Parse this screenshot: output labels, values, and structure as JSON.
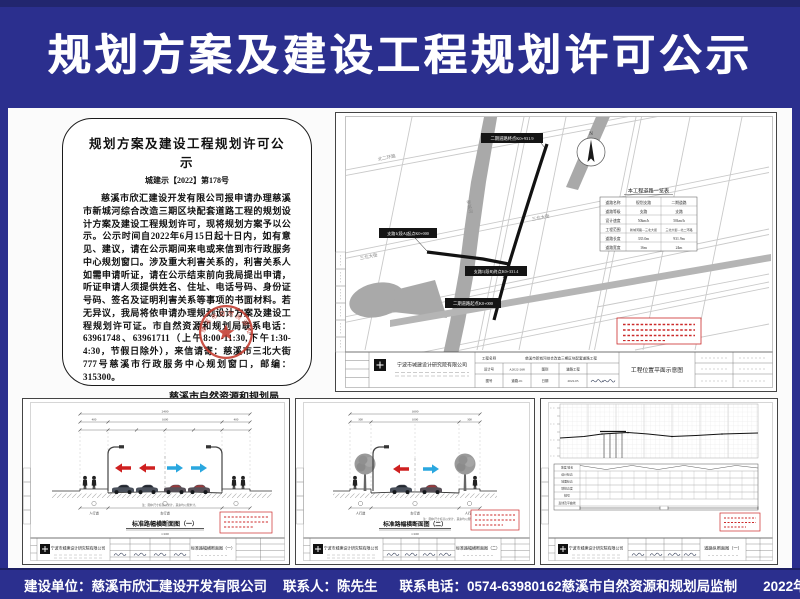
{
  "banner": {
    "title": "规划方案及建设工程规划许可公示"
  },
  "notice": {
    "title": "规划方案及建设工程规划许可公示",
    "doc_no": "城建示【2022】第178号",
    "body": "慈溪市欣汇建设开发有限公司报申请办理慈溪市新城河综合改造三期区块配套道路工程的规划设计方案及建设工程规划许可，现将规划方案予以公示。公示时间自2022年6月15日起十日内，如有意见、建议，请在公示期间来电或来信到市行政服务中心规划窗口。涉及重大利害关系的，利害关系人如需申请听证，请在公示结束前向我局提出申请，听证申请人须提供姓名、住址、电话号码、身份证号码、签名及证明利害关系等事项的书面材料。若无异议，我局将依申请办理规划设计方案及建设工程规划许可证。市自然资源和规划局联系电话：63961748、63961711（上午8:00-11:30,下午1:30-4:30，节假日除外），来信请寄：慈溪市三北大街777号慈溪市行政服务中心规划窗口，邮编：315300。",
    "signature": "慈溪市自然资源和规划局",
    "date": "二〇二二年六月十四日"
  },
  "company": "宁波市城建设计研究院有限公司",
  "site_plan": {
    "project_label": "工程名称",
    "project_name": "慈溪市新城河综合改造三期区块配套道路工程",
    "drawing_title": "工程位置平面示意图",
    "design_no_label": "设计号",
    "design_no": "A2022-268",
    "category_label": "图别",
    "category": "道路工程",
    "sheet_label": "图号",
    "sheet": "道路-01",
    "date_label": "日期",
    "date_value": "2022.05",
    "north_label": "N",
    "road_table": {
      "title": "本工程道路一览表",
      "rows": [
        [
          "道路名称",
          "规划支路",
          "二期道路"
        ],
        [
          "道路等级",
          "支路",
          "支路"
        ],
        [
          "设计速度",
          "50km/h",
          "50km/h"
        ],
        [
          "工程范围",
          "新城河路—三北大街",
          "三北大街—北二环路"
        ],
        [
          "道路长度",
          "335.0m",
          "931.9m"
        ],
        [
          "道路宽度",
          "16m",
          "24m"
        ]
      ]
    },
    "route_labels": {
      "end2": "二期道路终点K0+931.9",
      "branch_start": "支路1(段A)起点K0+000",
      "branch_end": "支路1(段B)终点K0+331.4",
      "start2": "二期道路起点K0+000"
    },
    "streets": {
      "north_ring": "北二环路",
      "sanbei": "三北大街",
      "sanbei2": "三北大街",
      "river": "新城河"
    }
  },
  "section_a": {
    "title": "标准路幅横断面图（一）",
    "scale": "1:100",
    "dim_total": "2400",
    "dim_left": "400",
    "dim_mid": "1600",
    "dim_right": "400",
    "zone_left": "人行道",
    "zone_mid": "车行道",
    "zone_right": "人行道",
    "note": "注：图中尺寸标高以米计，其余均以厘米计。"
  },
  "section_b": {
    "title": "标准路幅横断面图（二）",
    "scale": "1:100",
    "dim_total": "1600",
    "dim_left": "300",
    "dim_mid": "1000",
    "dim_right": "300",
    "zone_left": "人行道",
    "zone_mid": "车行道",
    "zone_right": "人行道",
    "note": "注：图中尺寸标高以米计，其余均以厘米计。"
  },
  "profile_c": {
    "title": "道路纵断面图（一）",
    "row_labels": [
      "坡度/坡长",
      "设计标高",
      "地面标高",
      "填挖高度",
      "桩号",
      "直线及平曲线"
    ]
  },
  "footer": {
    "builder": "建设单位：慈溪市欣汇建设开发有限公司",
    "contact": "联系人：陈先生",
    "phone": "联系电话：0574-63980162",
    "supervisor": "慈溪市自然资源和规划局监制",
    "date": "2022年6月14日"
  },
  "colors": {
    "banner_blue": "#2b2f8e",
    "seal_red": "#c23b2e",
    "arrow_red": "#cf2020",
    "arrow_blue": "#2aa7df"
  }
}
